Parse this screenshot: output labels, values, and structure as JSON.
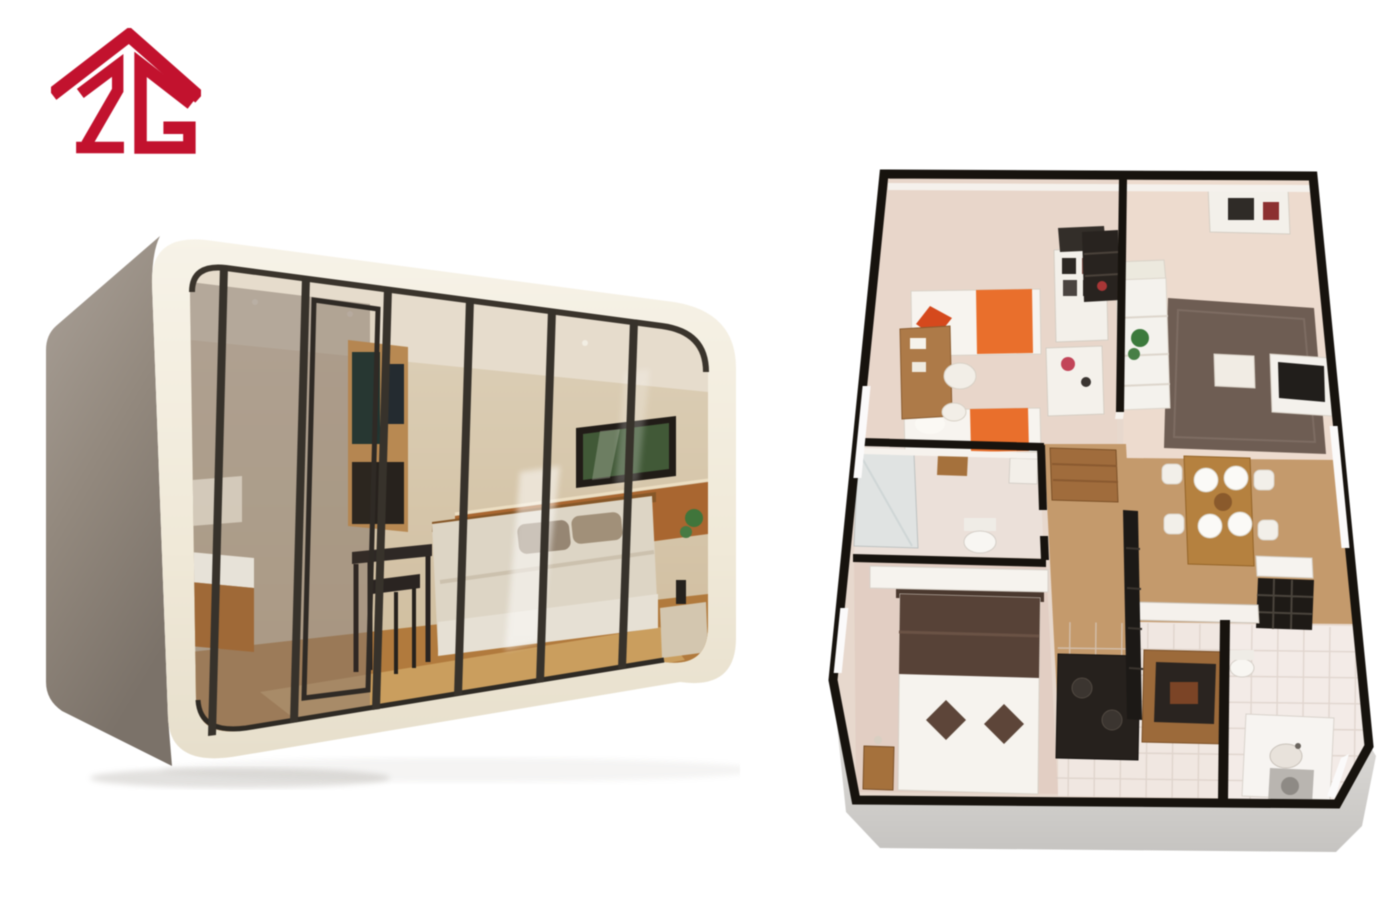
{
  "page": {
    "background_color": "#ffffff"
  },
  "logo": {
    "text": "2G",
    "aria_label": "2G house-roof logo",
    "color": "#c2122e"
  },
  "capsule_render": {
    "aria_label": "Capsule cabin with rounded white shell and glass front showing a bedroom interior",
    "shell_color": "#f2ecdd",
    "side_panel_color": "#978d82",
    "glass_frame_color": "#352f29",
    "interior_wall_color": "#e3d3b6",
    "ceiling_color": "#f2ead9",
    "wainscot_color": "#b06a30",
    "wood_floor_color": "#b97f3e",
    "bedding_color": "#e9e2d2",
    "pillow_color": "#9c8c79"
  },
  "floor_plan_render": {
    "aria_label": "3D isometric floor plan of a two-bedroom unit with living, dining, kitchen and two bathrooms",
    "outer_wall_color": "#17130e",
    "wood_floor_color": "#c49a6c",
    "bedroom_carpet_color": "#e8d6ca",
    "living_floor_color": "#eddbce",
    "master_carpet_color": "#e2cec3",
    "tile_color": "#f2eae6",
    "base_color": "#d9d7d4",
    "bed_blanket_color": "#e96f2c",
    "bed_pillow_color": "#d5491d",
    "master_blanket_color": "#574237",
    "master_pillow_color": "#5d4539",
    "rug_color": "#6e5d53",
    "sofa_color": "#f4f2ed",
    "dining_table_color": "#b5813f",
    "appliance_color": "#26211d",
    "cabinet_wood_color": "#9c6a3a"
  }
}
